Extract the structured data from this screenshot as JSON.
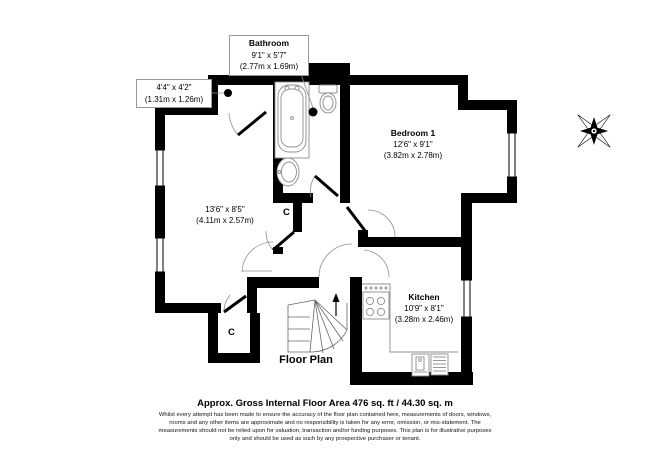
{
  "plan": {
    "title": "Floor Plan",
    "rooms": {
      "bathroom": {
        "name": "Bathroom",
        "imperial": "9'1\" x 5'7\"",
        "metric": "(2.77m x 1.69m)"
      },
      "entry_nook": {
        "imperial": "4'4\" x 4'2\"",
        "metric": "(1.31m x 1.26m)"
      },
      "bedroom": {
        "name": "Bedroom 1",
        "imperial": "12'6\" x 9'1\"",
        "metric": "(3.82m x 2.78m)"
      },
      "living_room": {
        "imperial": "13'6\" x 8'5\"",
        "metric": "(4.11m x 2.57m)"
      },
      "kitchen": {
        "name": "Kitchen",
        "imperial": "10'9\" x 8'1\"",
        "metric": "(3.28m x 2.46m)"
      }
    },
    "cupboard_label_1": "C",
    "cupboard_label_2": "C"
  },
  "footer": {
    "heading": "Approx. Gross Internal Floor Area 476 sq. ft / 44.30 sq. m",
    "disclaimer_lines": [
      "Whilst every attempt has been made to ensure the accuracy of the floor plan contained here, measurements of doors, windows,",
      "rooms and any other items are approximate and no responsibility is taken for any error, omission, or mis-statement. The",
      "measurements should not be relied upon for valuation, transaction and/or funding purposes. This plan is for illustrative purposes",
      "only and should be used as such by any prospective purchaser or tenant."
    ]
  },
  "icons": {
    "compass": "compass-rose",
    "stairs": "winder-stairs",
    "stairs_direction": "up-arrow",
    "bath": "bathtub",
    "toilet": "toilet",
    "basin": "wash-basin",
    "hob": "cooker-hob",
    "sink_unit": "kitchen-sink",
    "appliance": "appliance-rack"
  },
  "colors": {
    "wall": "#000000",
    "fixture_line": "#8c8c8c",
    "door_arc": "#909090",
    "stair_line": "#666666",
    "label_box_border": "#9a9a9a",
    "text": "#000000",
    "background": "#ffffff"
  }
}
